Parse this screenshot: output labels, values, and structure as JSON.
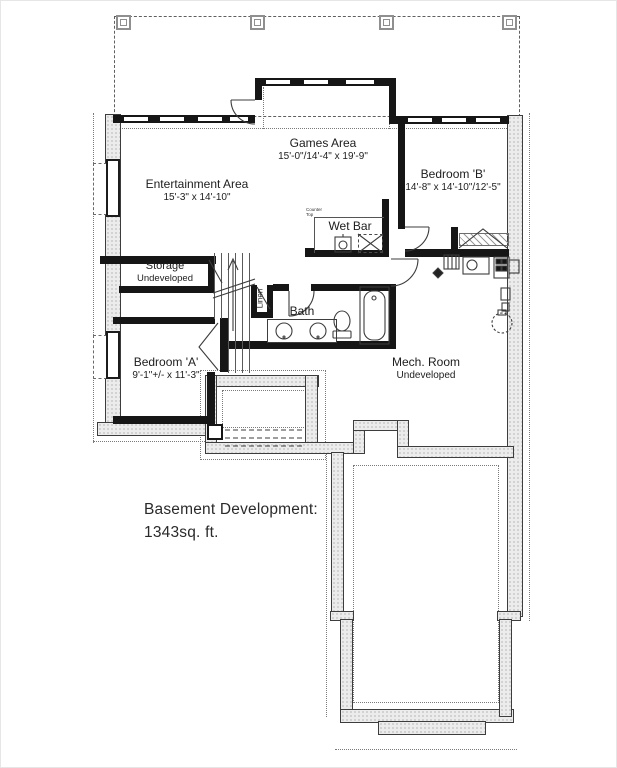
{
  "plan": {
    "title": {
      "line1": "Basement Development:",
      "line2": "1343sq. ft."
    },
    "rooms": {
      "games": {
        "name": "Games Area",
        "dims": "15'-0\"/14'-4\" x 19'-9\""
      },
      "entertainment": {
        "name": "Entertainment Area",
        "dims": "15'-3\" x 14'-10\""
      },
      "bedroom_b": {
        "name": "Bedroom 'B'",
        "dims": "14'-8\" x 14'-10\"/12'-5\""
      },
      "bedroom_a": {
        "name": "Bedroom 'A'",
        "dims": "9'-1\"+/- x 11'-3\""
      },
      "wet_bar": {
        "name": "Wet Bar",
        "note": "Counter Top"
      },
      "storage": {
        "name": "Storage",
        "status": "Undeveloped"
      },
      "mech": {
        "name": "Mech. Room",
        "status": "Undeveloped"
      },
      "bath": {
        "name": "Bath"
      },
      "linen": {
        "name": "Linen"
      }
    },
    "colors": {
      "wall": "#161616",
      "foundation_fill": "#ececec",
      "line": "#3d3d3d",
      "paper": "#ffffff"
    }
  }
}
